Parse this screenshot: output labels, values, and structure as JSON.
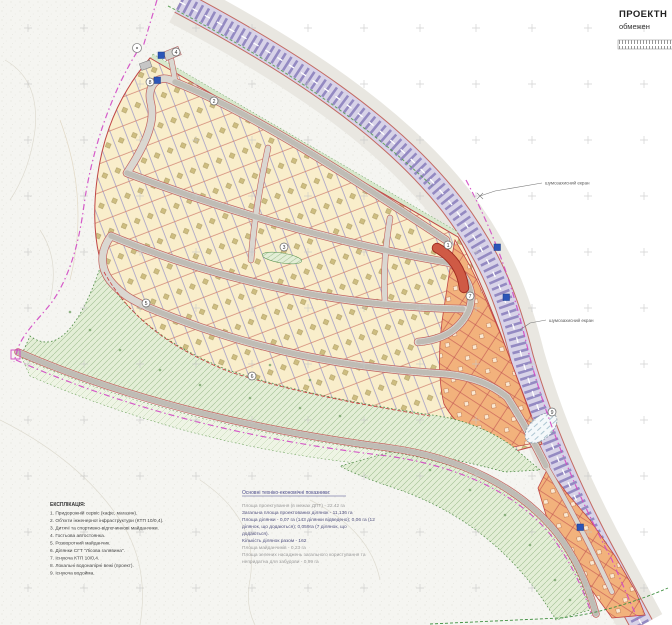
{
  "title_block": {
    "line1": "ПРОЕКТН",
    "line2": "обмежен"
  },
  "map_labels": {
    "noise_screen_1": "шумозахисний екран",
    "noise_screen_2": "шумозахисний екран"
  },
  "legend": {
    "header": "ЕКСПЛІКАЦІЯ:",
    "items": [
      "1. Придорожній сервіс (кафе, магазин).",
      "2. Об'єкти інженерної інфраструктури (КТП 10/0,4).",
      "3. Дитячі та спортивно-відпочинкові майданчики.",
      "4. Гостьова автостоянка.",
      "5. Розворотний майданчик.",
      "6. Ділянки СГТ \"Лісова галявина\".",
      "7. Існуюча КТП 10/0,4.",
      "8. Локальні водонапірні вежі (проект).",
      "9. Існуюча водойма."
    ]
  },
  "indicators": {
    "header": "Основні техніко-економічні показники:",
    "lines": [
      {
        "text": "Площа проектування (в межах ДПТ) - 22.42 га"
      },
      {
        "text": "Загальна площа проектованих ділянок - 11,136 га"
      },
      {
        "text": "Площа ділянки - 0,07 га (143 ділянки відведено); 0,06 га (12"
      },
      {
        "text": "ділянок, що додаються); 0,059га (7 ділянок, що"
      },
      {
        "text": "додаються)."
      },
      {
        "text": "Кількість ділянок разом - 162"
      },
      {
        "text": "Площа майданчиків - 0,23 га"
      },
      {
        "text": "Площа зелених насаджень загального користування та"
      },
      {
        "text": "непридатна для забудови - 0,99 га"
      }
    ]
  },
  "markers": [
    {
      "n": "1"
    },
    {
      "n": "2"
    },
    {
      "n": "3"
    },
    {
      "n": "4"
    },
    {
      "n": "5"
    },
    {
      "n": "6"
    },
    {
      "n": "7"
    },
    {
      "n": "8"
    },
    {
      "n": "9"
    }
  ],
  "colors": {
    "plot_cream": "#f9eecb",
    "plot_orange": "#f2b27c",
    "highway_purple": "#948ac2",
    "boundary_magenta": "#d24ac4",
    "green_area": "#e3eed6",
    "water_tower_blue": "#2b55b8",
    "service_red": "#cf5a45"
  }
}
